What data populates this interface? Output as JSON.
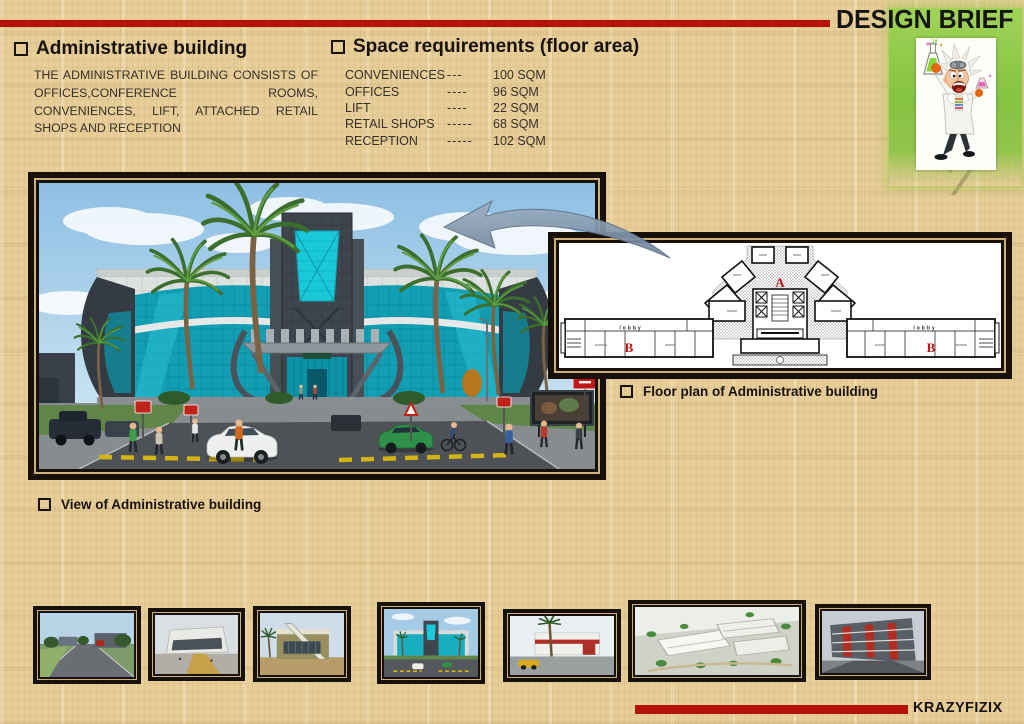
{
  "header": {
    "title": "DESIGN BRIEF"
  },
  "page_number": "7",
  "mascot": {
    "icon": "mad-scientist-icon"
  },
  "admin_section": {
    "heading": "Administrative building",
    "body": "THE ADMINISTRATIVE BUILDING CONSISTS OF OFFICES,CONFERENCE ROOMS, CONVENIENCES, LIFT, ATTACHED RETAIL SHOPS AND RECEPTION"
  },
  "space_section": {
    "heading": "Space requirements (floor area)",
    "items": [
      {
        "label": "CONVENIENCES",
        "dashes": "---",
        "value": "100 SQM"
      },
      {
        "label": "OFFICES",
        "dashes": "----",
        "value": "96 SQM"
      },
      {
        "label": "LIFT",
        "dashes": "----",
        "value": "22 SQM"
      },
      {
        "label": "RETAIL SHOPS",
        "dashes": "-----",
        "value": "68 SQM"
      },
      {
        "label": "RECEPTION",
        "dashes": "-----",
        "value": "102 SQM"
      }
    ]
  },
  "captions": {
    "view": "View of Administrative building",
    "plan": "Floor plan of Administrative building"
  },
  "plan": {
    "zone_a": "A",
    "zone_b": "B",
    "lobby": "lobby"
  },
  "footer": {
    "brand": "KRAZYFIZIX"
  },
  "colors": {
    "accent_red": "#b31309",
    "panel_green": "#86c341",
    "glass_teal": "#17c0d0",
    "frame_gold": "#cdb075",
    "paper_tan": "#e7cd98"
  }
}
